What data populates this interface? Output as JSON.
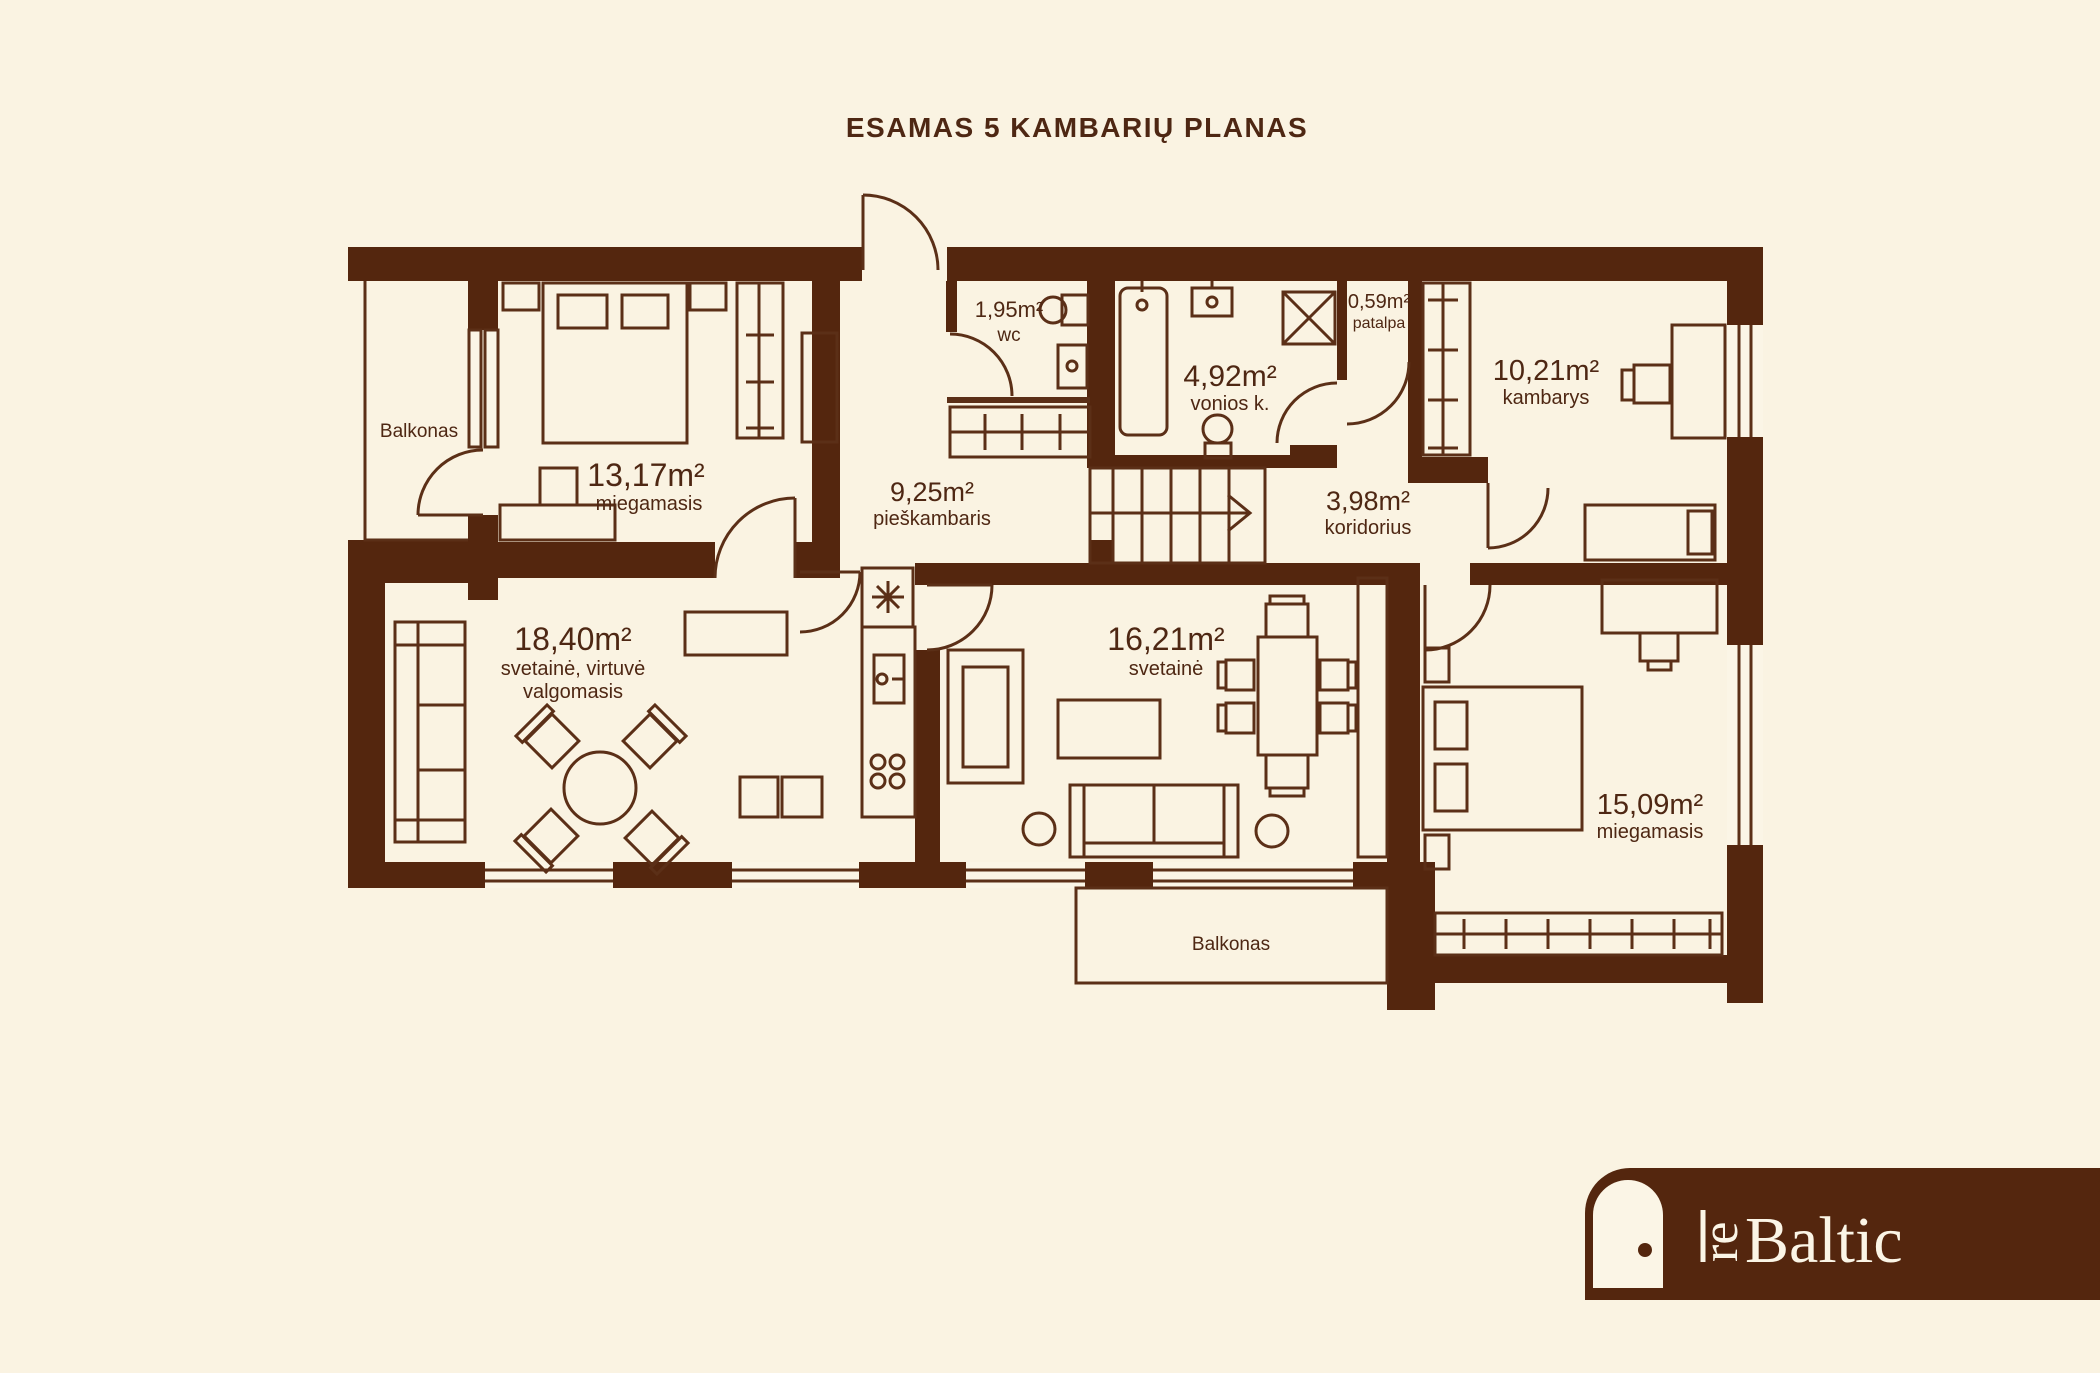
{
  "title": "ESAMAS 5 KAMBARIŲ PLANAS",
  "colors": {
    "background": "#FAF3E2",
    "wall": "#54260E",
    "line": "#5B2F17",
    "text": "#4E2713",
    "logo_background": "#54260E",
    "logo_foreground": "#FBF5E6"
  },
  "rooms": {
    "balkonas_left": {
      "name": "Balkonas"
    },
    "miegamasis_13": {
      "area": "13,17m²",
      "name": "miegamasis"
    },
    "wc": {
      "area": "1,95m²",
      "name": "wc"
    },
    "vonios": {
      "area": "4,92m²",
      "name": "vonios k."
    },
    "patalpa": {
      "area": "0,59m²",
      "name": "patalpa"
    },
    "kambarys_10": {
      "area": "10,21m²",
      "name": "kambarys"
    },
    "pieskambaris": {
      "area": "9,25m²",
      "name": "pieškambaris"
    },
    "koridorius": {
      "area": "3,98m²",
      "name": "koridorius"
    },
    "svetaine_18": {
      "area": "18,40m²",
      "name": "svetainė, virtuvė",
      "name2": "valgomasis"
    },
    "svetaine_16": {
      "area": "16,21m²",
      "name": "svetainė"
    },
    "miegamasis_15": {
      "area": "15,09m²",
      "name": "miegamasis"
    },
    "balkonas_bottom": {
      "name": "Balkonas"
    }
  },
  "logo": {
    "icon": "door",
    "prefix": "re",
    "name": "Baltic"
  }
}
